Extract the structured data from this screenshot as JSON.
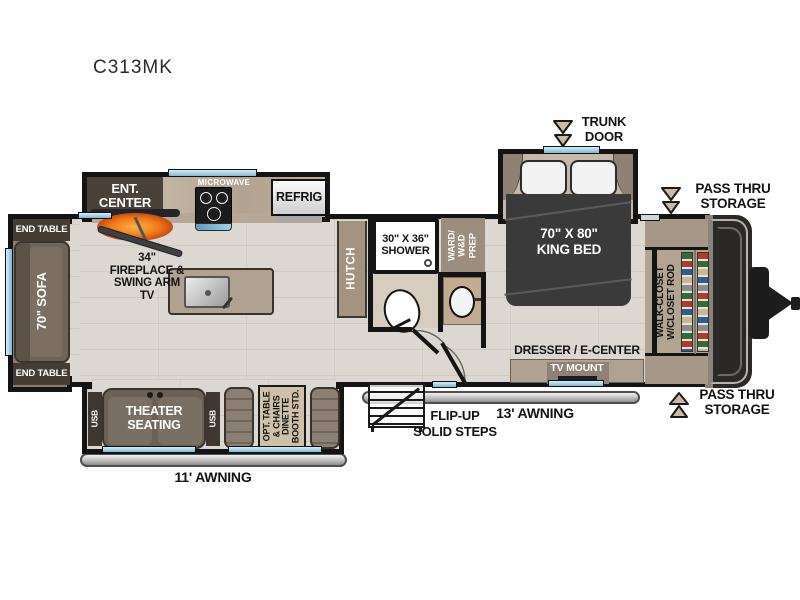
{
  "model": "C313MK",
  "colors": {
    "floor": "#dcd8d1",
    "wall": "#141414",
    "window_blue": "#a9d6ea",
    "counter_tan": "#b0a191",
    "cabinet_dark": "#463d34",
    "sofa_brown": "#6e6459",
    "bed_charcoal": "#3a3a3a",
    "fireplace_orange": "#e05818",
    "awning_gray": "#c9c9c9",
    "arrow_tan": "#cbb9a1"
  },
  "labels": {
    "trunk_door": "TRUNK\nDOOR",
    "pass_thru_top": "PASS THRU\nSTORAGE",
    "pass_thru_bottom": "PASS THRU\nSTORAGE",
    "awning_13": "13' AWNING",
    "awning_11": "11' AWNING",
    "steps": "FLIP-UP\nSOLID STEPS"
  },
  "living_area": {
    "end_table_top": "END TABLE",
    "end_table_bottom": "END TABLE",
    "sofa": "70\" SOFA",
    "ent_center": "ENT.\nCENTER",
    "fireplace": "34\"\nFIREPLACE &\nSWING ARM\nTV",
    "theater_seating": "THEATER\nSEATING",
    "usb_left": "USB",
    "usb_right": "USB",
    "dinette": "OPT. TABLE\n& CHAIRS\nDINETTE\nBOOTH STD."
  },
  "kitchen": {
    "microwave": "MICROWAVE",
    "refrig": "REFRIG",
    "hutch": "HUTCH"
  },
  "bathroom": {
    "shower": "30\" X 36\"\nSHOWER",
    "wardrobe": "WARD/\nW&D\nPREP"
  },
  "bedroom": {
    "king_bed": "70\" X 80\"\nKING BED",
    "dresser": "DRESSER / E-CENTER",
    "tv_mount": "TV MOUNT",
    "walk_closet": "WALK-CLOSET\nW/CLOSET ROD"
  }
}
